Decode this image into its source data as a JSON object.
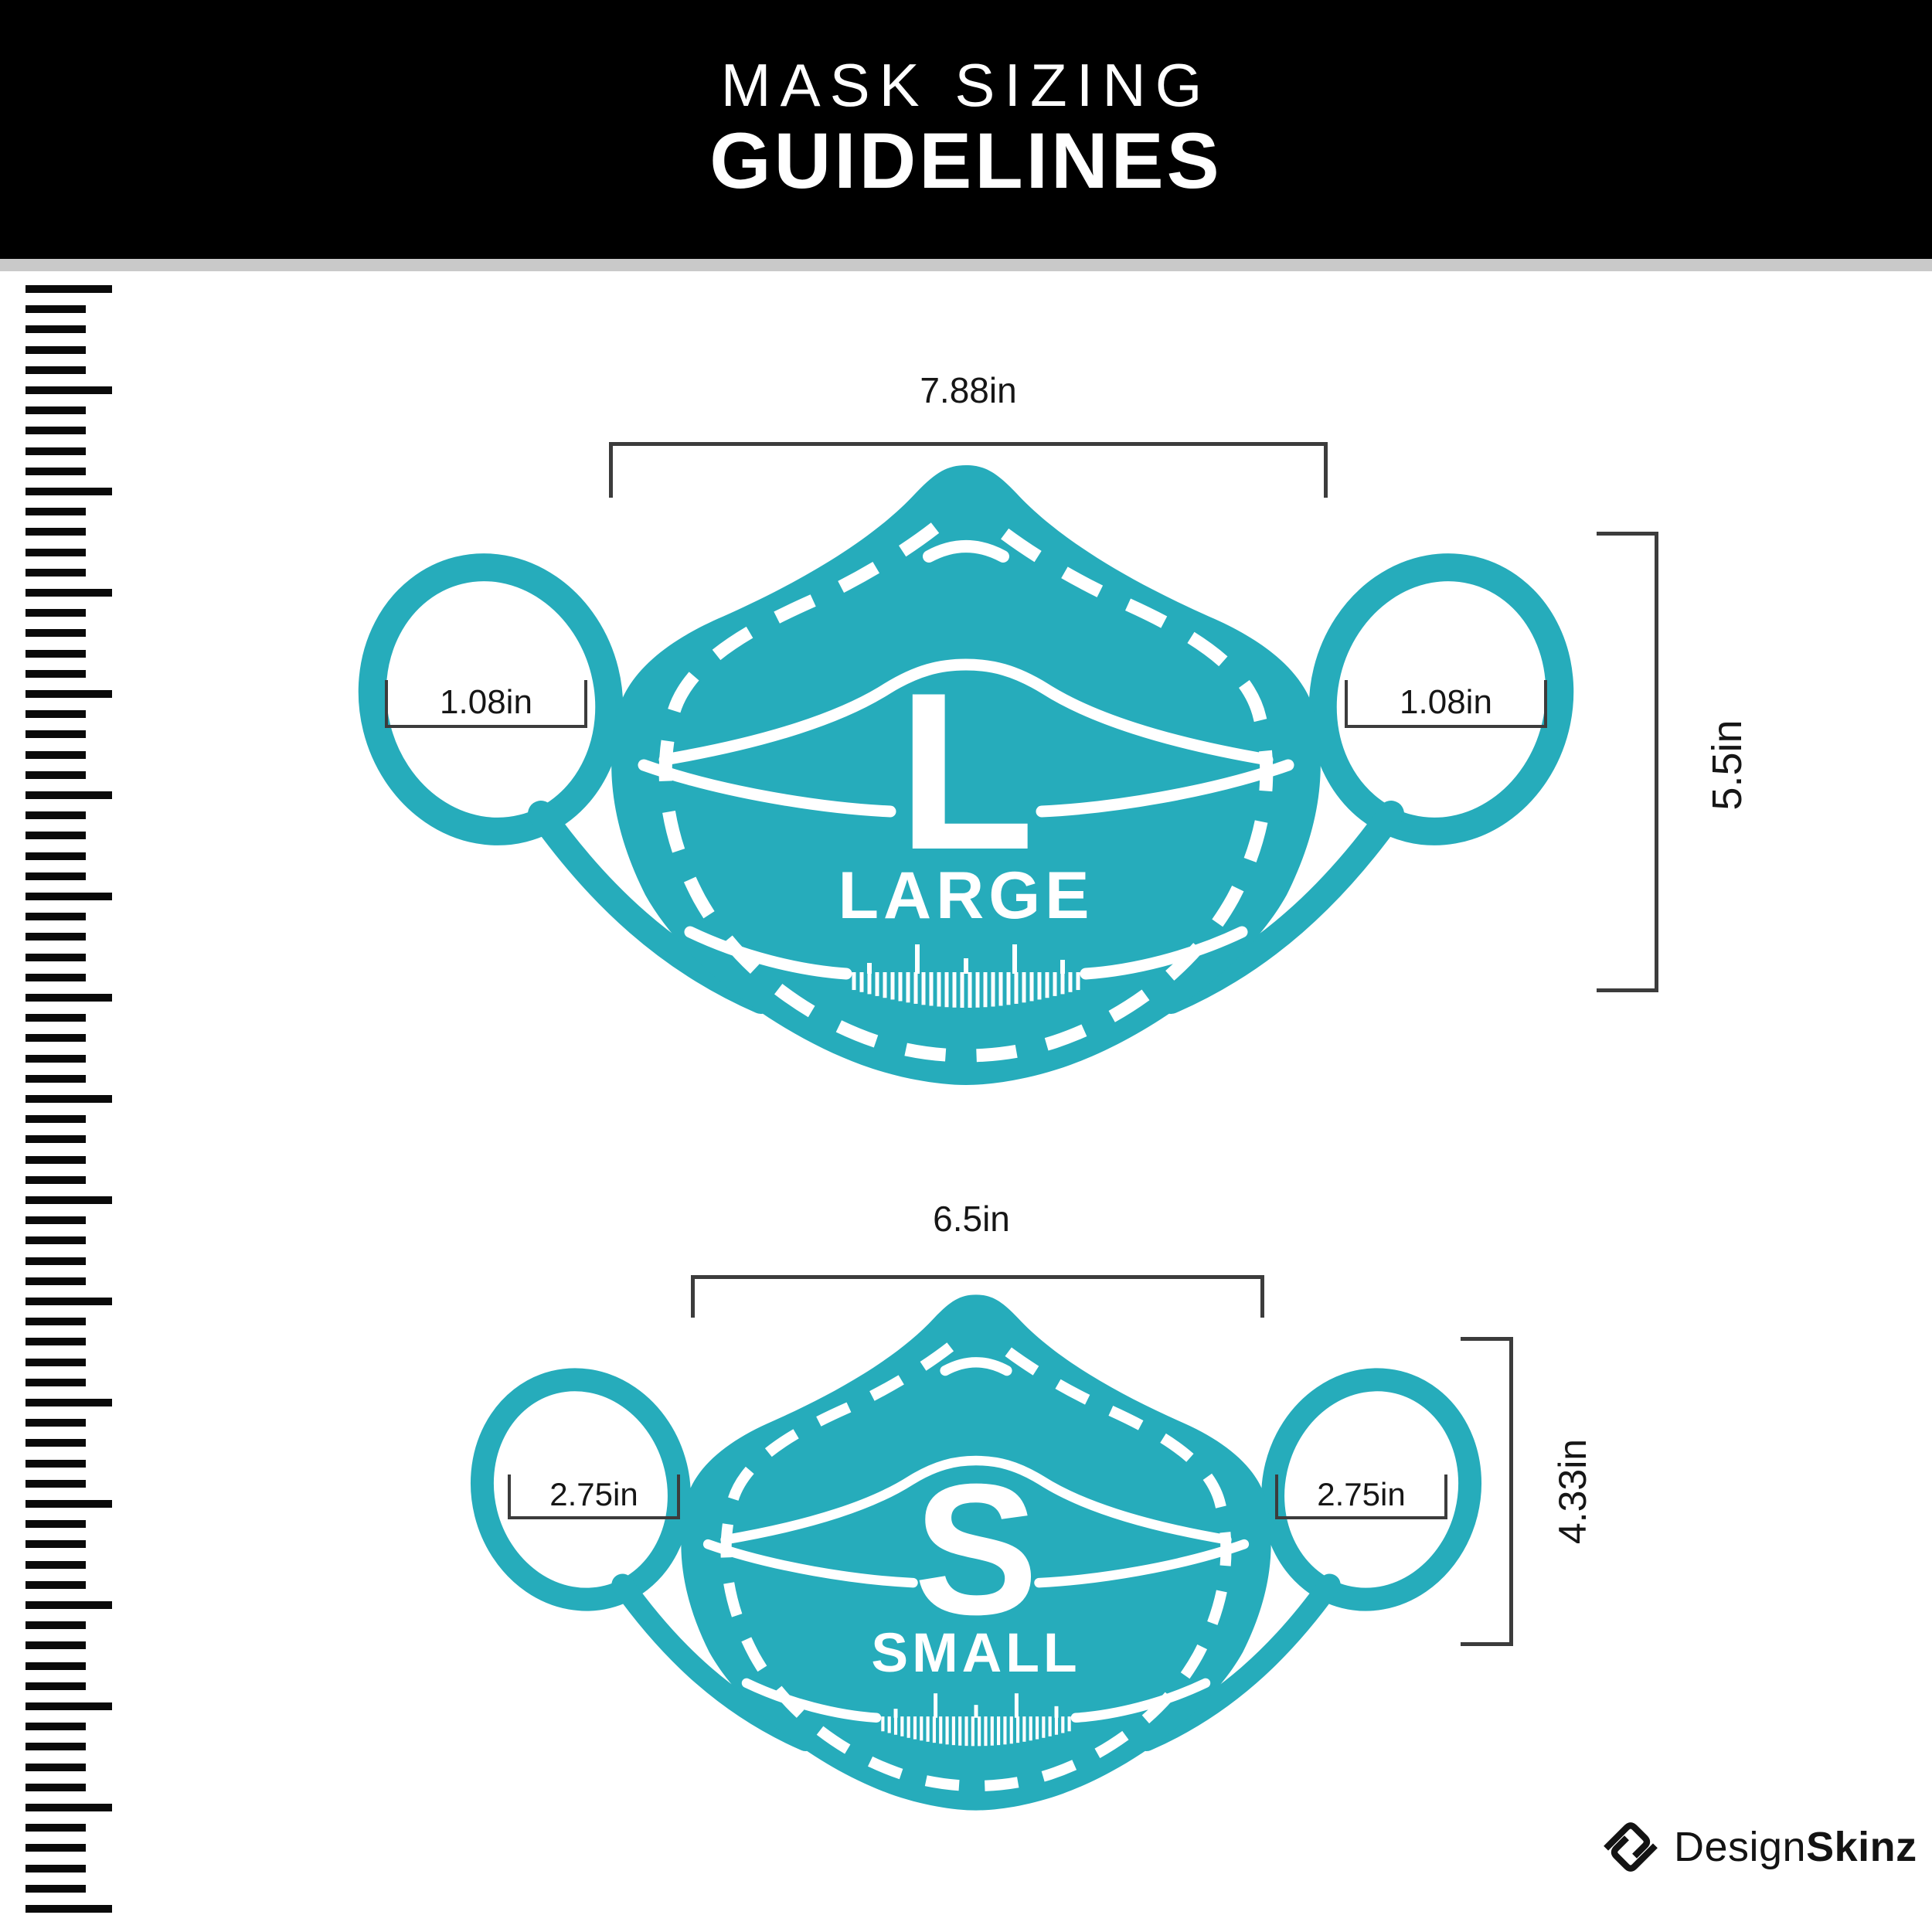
{
  "header": {
    "title_line1": "MASK SIZING",
    "title_line2": "GUIDELINES"
  },
  "masks": [
    {
      "id": "large",
      "size_letter": "L",
      "size_name": "LARGE",
      "width_label": "7.88in",
      "ear_left_label": "1.08in",
      "ear_right_label": "1.08in",
      "height_label": "5.5in"
    },
    {
      "id": "small",
      "size_letter": "S",
      "size_name": "SMALL",
      "width_label": "6.5in",
      "ear_left_label": "2.75in",
      "ear_right_label": "2.75in",
      "height_label": "4.33in"
    }
  ],
  "logo": {
    "name_regular": "Design",
    "name_bold": "Skinz"
  },
  "colors": {
    "mask_teal": "#26ACBB",
    "header_bg": "#000000",
    "header_text": "#ffffff",
    "gray_strip": "#c9c9c9",
    "dimension_lines": "#3c3c3c",
    "ruler_black": "#0a0a0a"
  }
}
